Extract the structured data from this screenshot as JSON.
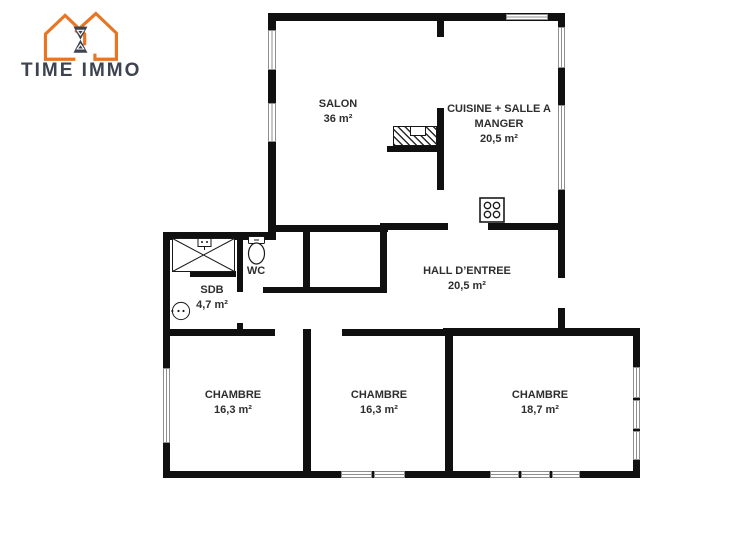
{
  "logo": {
    "brand": "TIME IMMO",
    "icon": "house-hourglass-icon",
    "accent_color": "#E87524",
    "text_color": "#3D4450"
  },
  "plan": {
    "wall_color": "#101010",
    "rooms": {
      "salon": {
        "name": "SALON",
        "area": "36 m²"
      },
      "cuisine": {
        "name_line1": "CUISINE + SALLE A",
        "name_line2": "MANGER",
        "area": "20,5 m²"
      },
      "wc": {
        "name": "WC"
      },
      "sdb": {
        "name": "SDB",
        "area": "4,7 m²"
      },
      "hall": {
        "name": "HALL D’ENTREE",
        "area": "20,5 m²"
      },
      "chambre1": {
        "name": "CHAMBRE",
        "area": "16,3 m²"
      },
      "chambre2": {
        "name": "CHAMBRE",
        "area": "16,3 m²"
      },
      "chambre3": {
        "name": "CHAMBRE",
        "area": "18,7 m²"
      }
    },
    "fixtures": [
      "shower-icon",
      "toilet-icon",
      "washbasin-icon",
      "stove-icon",
      "fireplace-icon"
    ]
  }
}
